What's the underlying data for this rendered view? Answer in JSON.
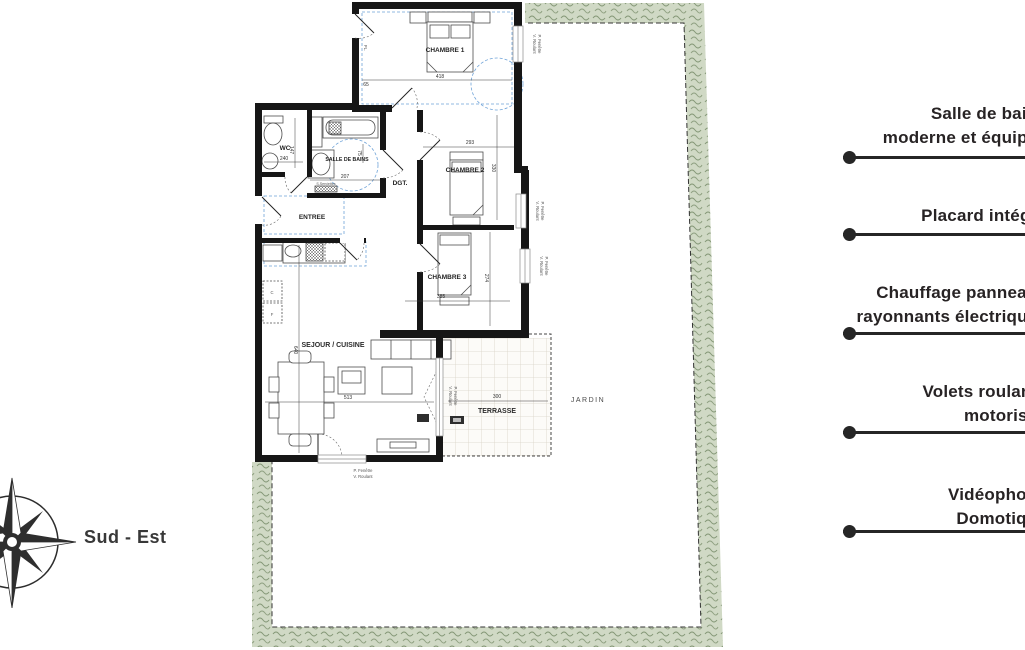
{
  "plan": {
    "rooms": {
      "chambre1": "CHAMBRE 1",
      "chambre2": "CHAMBRE 2",
      "chambre3": "CHAMBRE 3",
      "wc": "WC",
      "sdb": "SALLE DE BAINS",
      "entree": "ENTREE",
      "dgt": "DGT.",
      "sejour": "SEJOUR / CUISINE",
      "terrasse": "TERRASSE",
      "jardin": "JARDIN",
      "placard": "PL."
    },
    "dims": {
      "chambre1_w": "418",
      "pl_w": "65",
      "chambre2_w": "293",
      "chambre2_h": "330",
      "chambre3_w": "385",
      "chambre3_h": "274",
      "wc_a": "240",
      "wc_h": "147",
      "sdb_w": "207",
      "sdb_h": "75",
      "sejour_w": "513",
      "sejour_h": "640",
      "terrasse_w": "300"
    },
    "annotations": {
      "window_line1": "P. Fenêtre",
      "window_line2": "V. Roulant",
      "towel": "S.Serviettes",
      "c": "C",
      "f": "F"
    }
  },
  "compass": {
    "direction": "Sud - Est"
  },
  "features": [
    {
      "line1": "Salle de bains",
      "line2": "moderne et équipée"
    },
    {
      "line1": "Placard intégré",
      "line2": ""
    },
    {
      "line1": "Chauffage panneaux",
      "line2": "rayonnants électriques"
    },
    {
      "line1": "Volets roulants",
      "line2": "motorisés"
    },
    {
      "line1": "Vidéophone",
      "line2": "Domotique"
    }
  ],
  "colors": {
    "garden_band": "#d0d9c5",
    "garden_texture": "#7e9270",
    "wall": "#161616",
    "blue_dash": "#6fa3d8",
    "accent_text": "#272324"
  }
}
